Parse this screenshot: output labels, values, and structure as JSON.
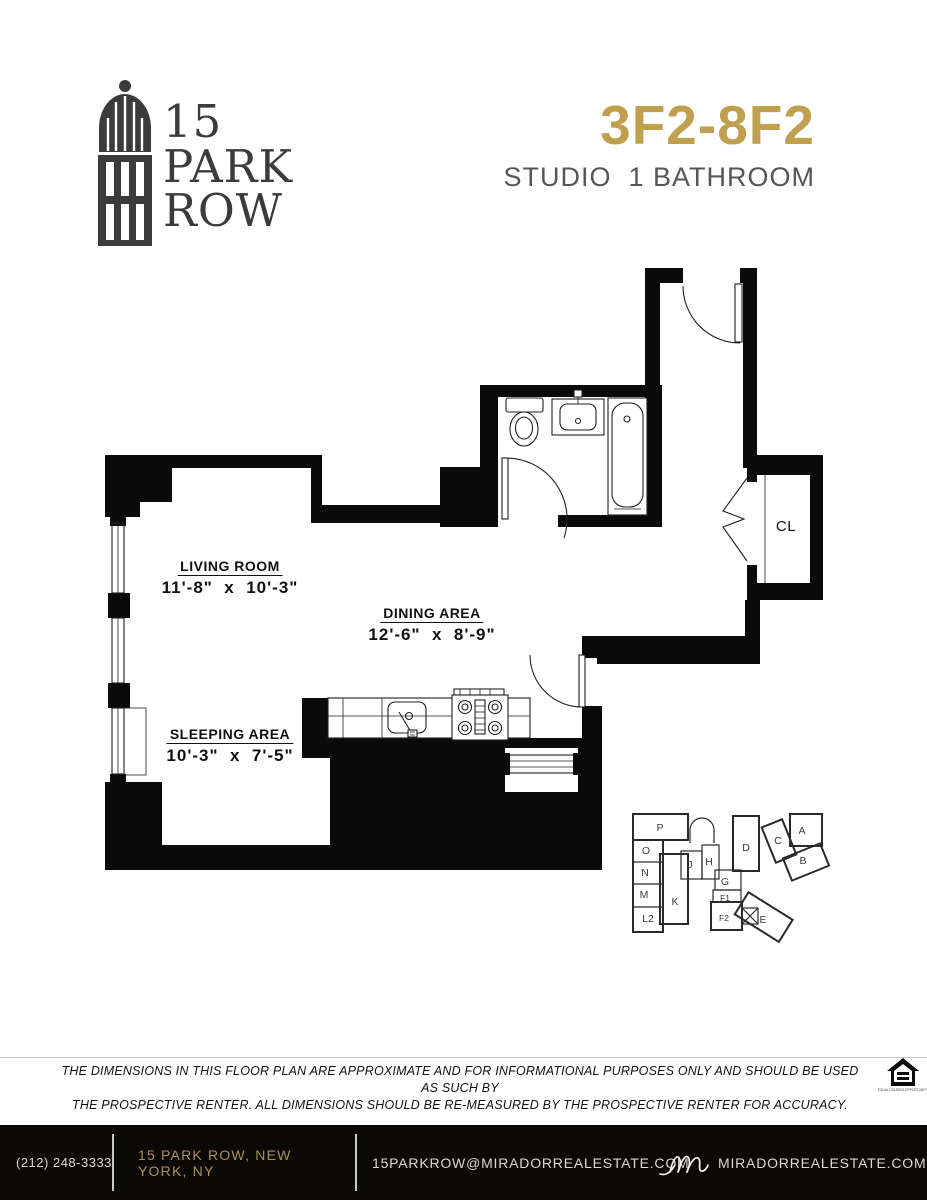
{
  "header": {
    "logo": {
      "line1": "15",
      "line2": "PARK",
      "line3": "ROW"
    },
    "unit_title": "3F2-8F2",
    "unit_subtitle": "STUDIO  1 BATHROOM"
  },
  "floorplan": {
    "rooms": {
      "living": {
        "name": "LIVING ROOM",
        "dims": "11'-8\"  x  10'-3\""
      },
      "dining": {
        "name": "DINING AREA",
        "dims": "12'-6\"  x  8'-9\""
      },
      "sleeping": {
        "name": "SLEEPING AREA",
        "dims": "10'-3\"  x  7'-5\""
      },
      "closet": {
        "name": "CL"
      }
    }
  },
  "keyplan": {
    "highlighted_unit": "F2",
    "units": [
      {
        "label": "P",
        "x": 660,
        "y": 831
      },
      {
        "label": "O",
        "x": 646,
        "y": 854
      },
      {
        "label": "N",
        "x": 645,
        "y": 876
      },
      {
        "label": "M",
        "x": 644,
        "y": 898
      },
      {
        "label": "L2",
        "x": 648,
        "y": 922
      },
      {
        "label": "K",
        "x": 675,
        "y": 905
      },
      {
        "label": "J",
        "x": 690,
        "y": 868
      },
      {
        "label": "H",
        "x": 709,
        "y": 865
      },
      {
        "label": "D",
        "x": 746,
        "y": 851
      },
      {
        "label": "G",
        "x": 725,
        "y": 885
      },
      {
        "label": "F1",
        "x": 725,
        "y": 901,
        "small": true
      },
      {
        "label": "F2",
        "x": 724,
        "y": 921,
        "small": true
      },
      {
        "label": "E",
        "x": 763,
        "y": 923
      },
      {
        "label": "C",
        "x": 778,
        "y": 844
      },
      {
        "label": "A",
        "x": 802,
        "y": 834
      },
      {
        "label": "B",
        "x": 803,
        "y": 864
      }
    ]
  },
  "disclaimer": {
    "line1": "THE DIMENSIONS IN THIS FLOOR PLAN ARE APPROXIMATE AND FOR INFORMATIONAL PURPOSES ONLY AND SHOULD BE USED AS SUCH BY",
    "line2": "THE PROSPECTIVE RENTER. ALL DIMENSIONS SHOULD BE RE-MEASURED BY THE PROSPECTIVE RENTER FOR ACCURACY.",
    "eho_label": "EQUAL HOUSING OPPORTUNITY"
  },
  "footer": {
    "phone": "(212) 248-3333",
    "address": "15 PARK ROW, NEW YORK, NY",
    "email": "15PARKROW@MIRADORREALESTATE.COM",
    "website": "MIRADORREALESTATE.COM"
  },
  "colors": {
    "accent_gold": "#C0A04E",
    "footer_gold": "#AB9055",
    "footer_bg": "#0B0908",
    "ink": "#3B3B3D",
    "keyplan_highlight": "#C9C9C9"
  }
}
